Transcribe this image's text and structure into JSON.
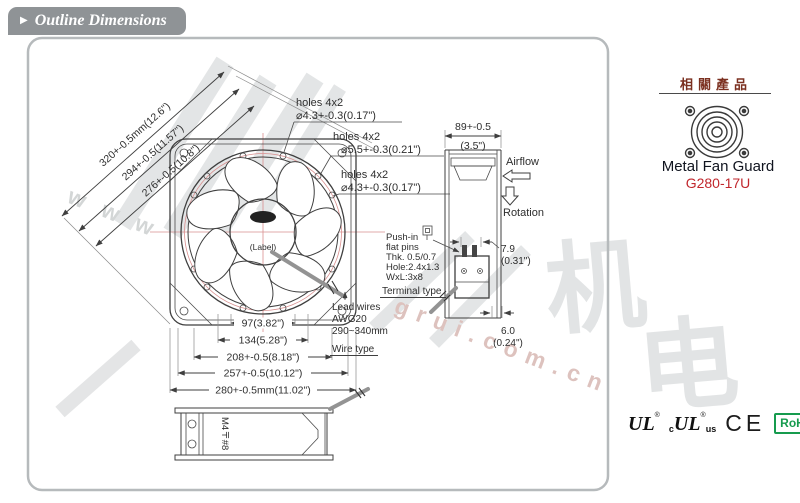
{
  "header": {
    "marker": "▶",
    "title": "Outline Dimensions"
  },
  "front": {
    "diag_dims": [
      "320+-0.5mm(12.6\")",
      "294+-0.5(11.57\")",
      "276+-0.5(10.8\")"
    ],
    "callouts": [
      {
        "t": "holes 4x2",
        "d": "⌀4.3+-0.3(0.17\")"
      },
      {
        "t": "holes 4x2",
        "d": "⌀5.5+-0.3(0.21\")"
      },
      {
        "t": "holes 4x2",
        "d": "⌀4.3+-0.3(0.17\")"
      }
    ],
    "hub_label": "(Label)",
    "bottom_dims": [
      "97(3.82\")",
      "134(5.28\")",
      "208+-0.5(8.18\")",
      "257+-0.5(10.12\")",
      "280+-0.5mm(11.02\")"
    ]
  },
  "side": {
    "width": "89+-0.5",
    "width_in": "(3.5\")",
    "airflow": "Airflow",
    "rotation": "Rotation",
    "pin": "7.9",
    "pin_in": "(0.31\")",
    "base": "6.0",
    "base_in": "(0.24\")"
  },
  "terminal": {
    "l1": "Push-in",
    "l2": "flat pins",
    "l3": "Thk. 0.5/0.7",
    "l4": "Hole:2.4x1.3",
    "l5": "WxL:3x8",
    "type": "Terminal type"
  },
  "wires": {
    "l1": "Lead wires",
    "l2": "AWG20",
    "l3": "290~340mm",
    "type": "Wire type"
  },
  "bottomview": {
    "screw": "M4〒#8"
  },
  "related": {
    "title": "相關產品",
    "name": "Metal Fan Guard",
    "model": "G280-17U"
  },
  "certs": {
    "ul": "UL",
    "reg": "®",
    "c": "c",
    "us": "us",
    "ce": "CE",
    "rohs": "RoHS"
  },
  "watermark": {
    "www": "w w w",
    "domain": "grui.com.cn",
    "big1": "机",
    "big2": "电"
  }
}
